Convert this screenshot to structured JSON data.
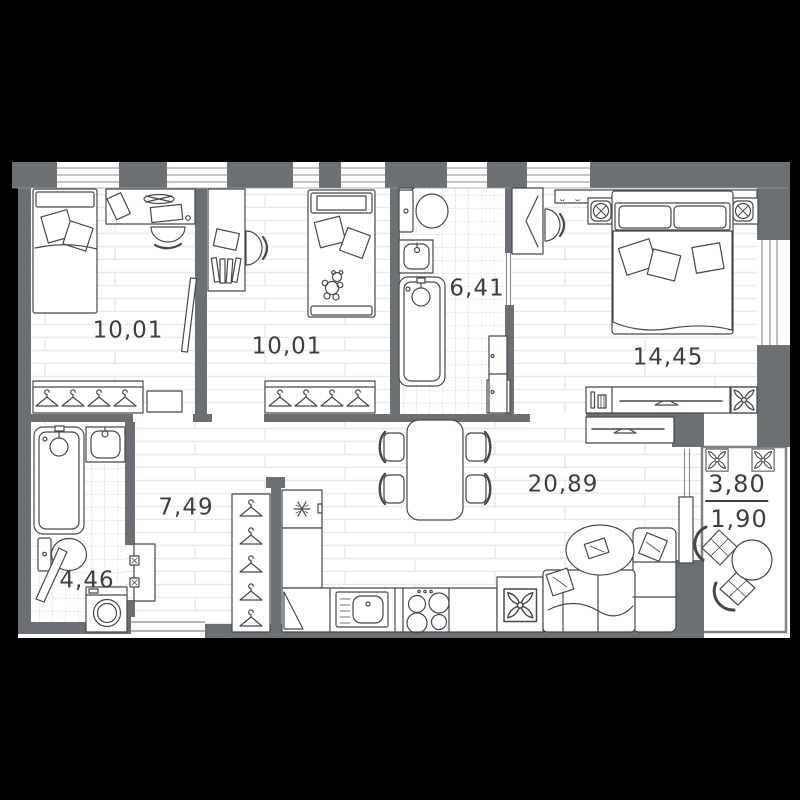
{
  "plan": {
    "title": "apartment-floor-plan",
    "background_color": "#000000",
    "floor_color": "#ffffff",
    "wall_color": "#6c6f74",
    "furniture_line_color": "#45484e",
    "label_color": "#3b3e43",
    "rooms": [
      {
        "name": "bedroom-1",
        "area": "10,01"
      },
      {
        "name": "bedroom-2",
        "area": "10,01"
      },
      {
        "name": "bathroom",
        "area": "6,41"
      },
      {
        "name": "bedroom-3",
        "area": "14,45"
      },
      {
        "name": "hallway",
        "area": "7,49"
      },
      {
        "name": "toilet-bathroom",
        "area": "4,46"
      },
      {
        "name": "kitchen-living-room",
        "area": "20,89"
      },
      {
        "name": "balcony",
        "area_total": "3,80",
        "area_reduced": "1,90"
      }
    ],
    "icons": [
      "single-bed-icon",
      "crib-bed-icon",
      "double-bed-icon",
      "teddy-bear-icon",
      "desk-icon",
      "desk-chair-icon",
      "wardrobe-hangers-icon",
      "hanger-icon",
      "mirror-door-icon",
      "toilet-icon",
      "washbasin-icon",
      "bathtub-icon",
      "storage-cabinet-icon",
      "nightstand-lamp-icon",
      "tv-dresser-icon",
      "tv-stand-icon",
      "plant-icon",
      "dining-table-icon",
      "dining-chair-icon",
      "fridge-icon",
      "kitchen-counter-icon",
      "kitchen-sink-icon",
      "stove-icon",
      "sofa-icon",
      "pillow-icon",
      "rug-icon",
      "bench-icon",
      "washing-machine-icon",
      "entrance-door-icon",
      "window-icon",
      "cafe-table-icon",
      "cafe-chair-icon"
    ]
  }
}
